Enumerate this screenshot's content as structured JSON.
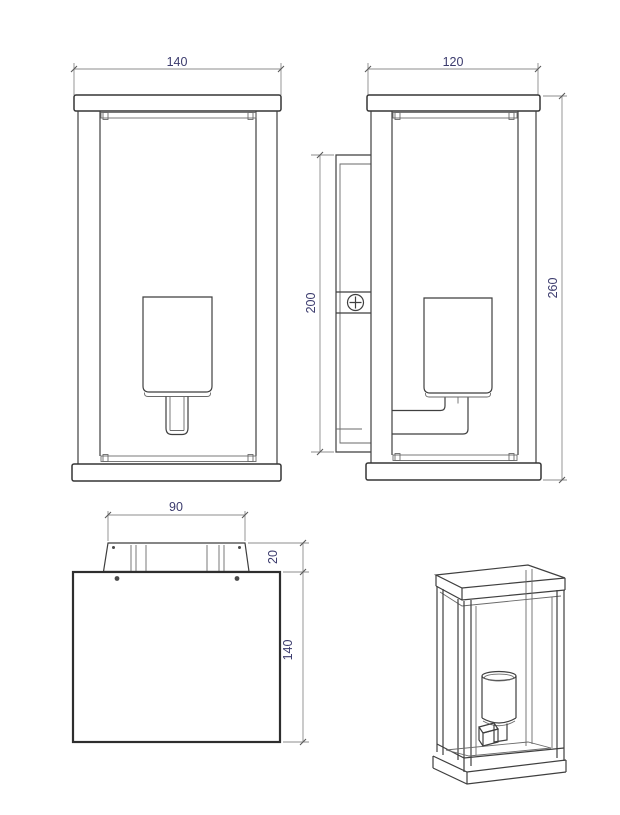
{
  "drawing": {
    "title": "Wall lantern technical drawing - four views",
    "colors": {
      "object_line": "#3f3f3f",
      "dimension_line": "#8c8c8c",
      "dimension_text": "#3b3b6d",
      "background": "#ffffff"
    },
    "views": {
      "front": {
        "name": "front view",
        "dims": {
          "width": "140"
        }
      },
      "side": {
        "name": "side view",
        "dims": {
          "width": "120",
          "height": "260",
          "backplate_height": "200"
        }
      },
      "top": {
        "name": "top view",
        "dims": {
          "bracket_width": "90",
          "bracket_depth": "20",
          "body_depth": "140"
        }
      },
      "perspective": {
        "name": "perspective view"
      }
    }
  }
}
